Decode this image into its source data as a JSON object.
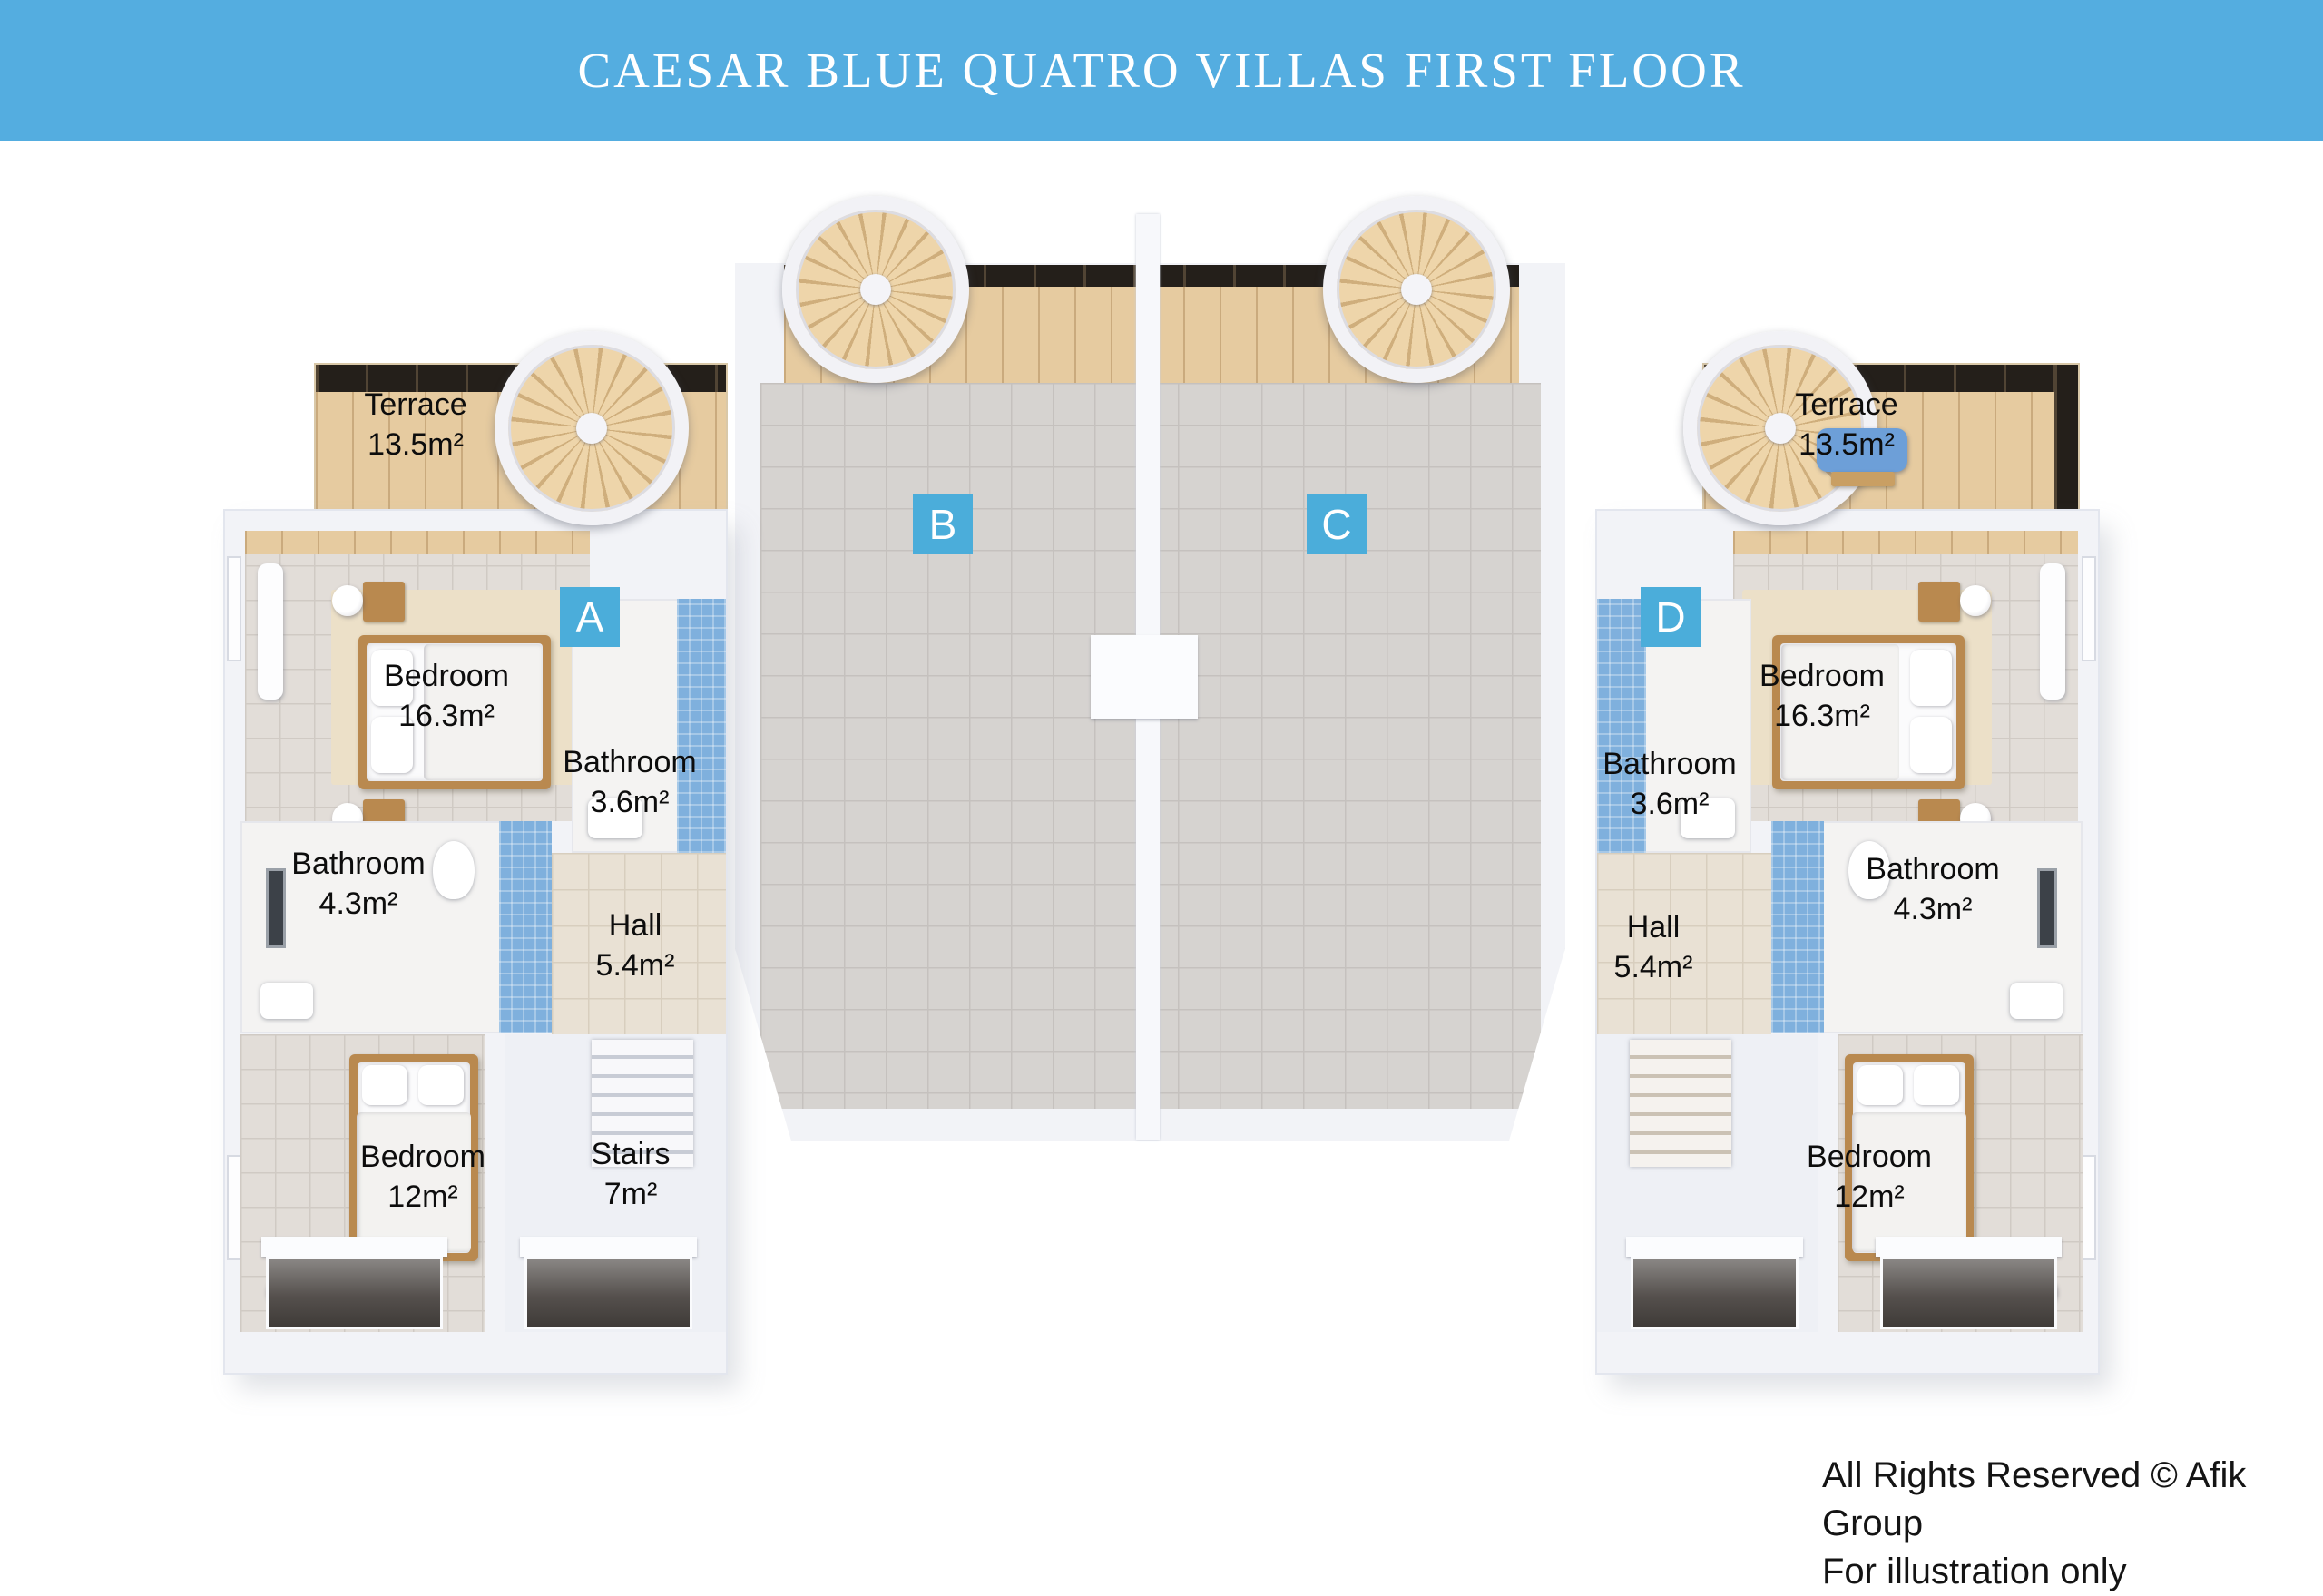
{
  "banner": {
    "title": "CAESAR BLUE QUATRO VILLAS FIRST FLOOR"
  },
  "units": {
    "a": "A",
    "b": "B",
    "c": "C",
    "d": "D"
  },
  "villa_left": {
    "terrace": {
      "name": "Terrace",
      "area": "13.5m²"
    },
    "bedroom_main": {
      "name": "Bedroom",
      "area": "16.3m²"
    },
    "bathroom_ensuite": {
      "name": "Bathroom",
      "area": "3.6m²"
    },
    "bathroom": {
      "name": "Bathroom",
      "area": "4.3m²"
    },
    "hall": {
      "name": "Hall",
      "area": "5.4m²"
    },
    "bedroom_second": {
      "name": "Bedroom",
      "area": "12m²"
    },
    "stairs": {
      "name": "Stairs",
      "area": "7m²"
    }
  },
  "villa_right": {
    "terrace": {
      "name": "Terrace",
      "area": "13.5m²"
    },
    "bedroom_main": {
      "name": "Bedroom",
      "area": "16.3m²"
    },
    "bathroom_ensuite": {
      "name": "Bathroom",
      "area": "3.6m²"
    },
    "bathroom": {
      "name": "Bathroom",
      "area": "4.3m²"
    },
    "hall": {
      "name": "Hall",
      "area": "5.4m²"
    },
    "bedroom_second": {
      "name": "Bedroom",
      "area": "12m²"
    }
  },
  "footer": {
    "line1": "All Rights Reserved © Afik Group",
    "line2": "For illustration only"
  },
  "colors": {
    "banner_blue": "#54ade0",
    "badge_blue": "#4badda"
  }
}
